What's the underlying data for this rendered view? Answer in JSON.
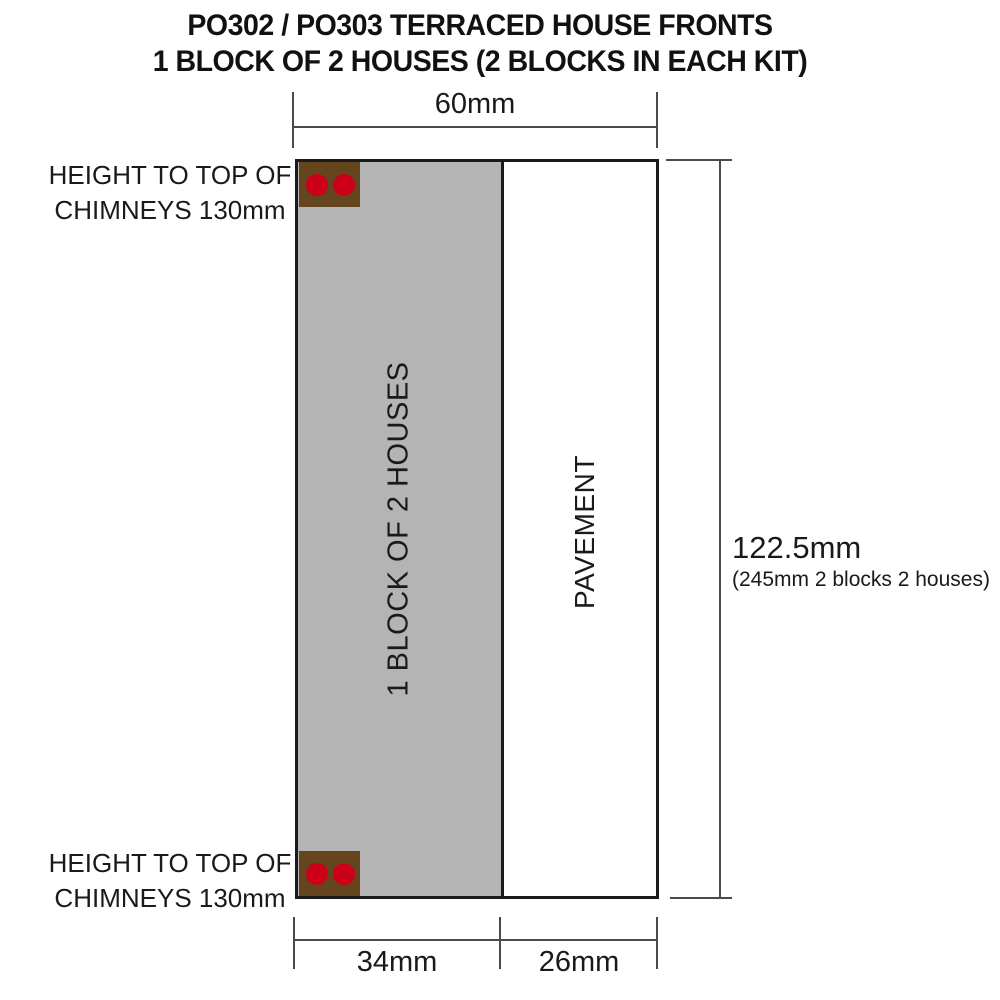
{
  "title": {
    "line1": "PO302 / PO303 TERRACED HOUSE FRONTS",
    "line2": "1 BLOCK OF 2 HOUSES (2 BLOCKS IN EACH KIT)"
  },
  "labels": {
    "house_block": "1 BLOCK OF 2 HOUSES",
    "pavement": "PAVEMENT",
    "chimney_note_top": {
      "line1": "HEIGHT TO TOP OF",
      "line2": "CHIMNEYS 130mm"
    },
    "chimney_note_bottom": {
      "line1": "HEIGHT TO TOP OF",
      "line2": "CHIMNEYS 130mm"
    }
  },
  "dimensions": {
    "width_top": "60mm",
    "height_right": "122.5mm",
    "height_right_note": "(245mm 2 blocks 2 houses)",
    "width_block": "34mm",
    "width_pavement": "26mm"
  },
  "colors": {
    "house_block_fill": "#b4b4b4",
    "chimney_fill": "#64451d",
    "chimney_pot": "#cc0019",
    "outline": "#1a1a1a",
    "dimension_line": "#4a4a4a"
  }
}
